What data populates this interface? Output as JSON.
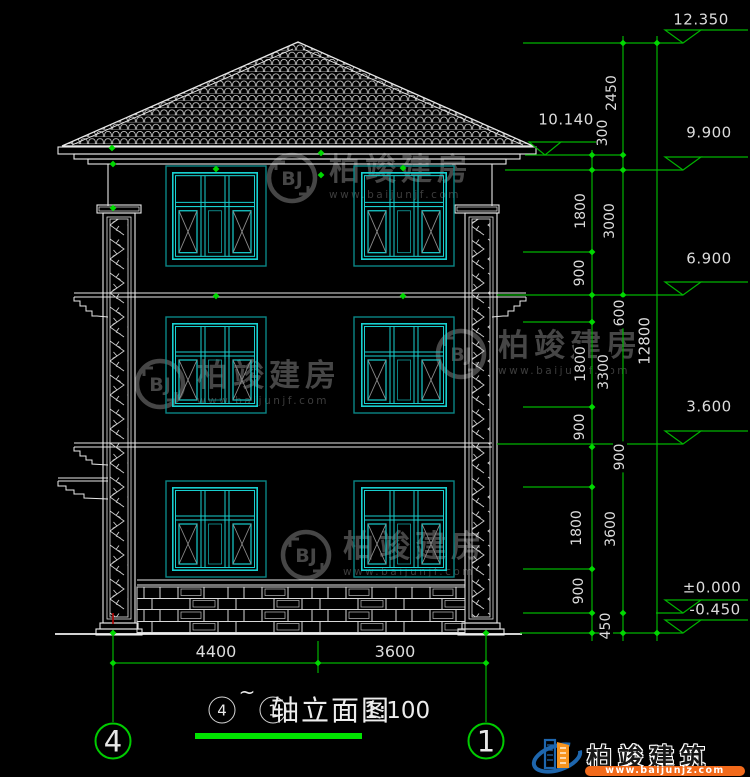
{
  "page": {
    "background": "#000000"
  },
  "colors": {
    "dim_green": "#00b400",
    "tick_green": "#00d800",
    "bright_green": "#00e400",
    "axis_green": "#00cc00",
    "line_white": "#e8e8e8",
    "window_teal": "#17cfcf",
    "window_trim": "#0a8585",
    "diagonal_gray": "#8a8a8a",
    "red_axis_mark": "#b30000",
    "watermark_gray": "#464646",
    "logo_blue": "#1e66ad",
    "logo_orange": "#f7941e",
    "logo_bar_orange": "#f26a1b"
  },
  "elevation_markers": [
    {
      "value": "12.350"
    },
    {
      "value": "10.140"
    },
    {
      "value": "9.900"
    },
    {
      "value": "6.900"
    },
    {
      "value": "3.600"
    },
    {
      "value": "±0.000"
    },
    {
      "value": "-0.450"
    }
  ],
  "vertical_dims": [
    {
      "value": "2450"
    },
    {
      "value": "300"
    },
    {
      "value": "1800"
    },
    {
      "value": "3000"
    },
    {
      "value": "900"
    },
    {
      "value": "600"
    },
    {
      "value": "12800"
    },
    {
      "value": "1800"
    },
    {
      "value": "3300"
    },
    {
      "value": "900"
    },
    {
      "value": "900"
    },
    {
      "value": "1800"
    },
    {
      "value": "3600"
    },
    {
      "value": "900"
    },
    {
      "value": "450"
    }
  ],
  "horizontal_dims": [
    {
      "value": "4400"
    },
    {
      "value": "3600"
    }
  ],
  "axis_bubbles": [
    {
      "label": "4"
    },
    {
      "label": "1"
    }
  ],
  "title": {
    "axis_from": "4",
    "separator": "~",
    "axis_to": "1",
    "text": "轴立面图",
    "scale": "1:100"
  },
  "watermark": {
    "monogram": "BJ",
    "brand": "柏竣建房",
    "url": "www.baijunjf.com"
  },
  "logo": {
    "brand": "柏竣建筑",
    "url": "www.baijunjz.com"
  }
}
